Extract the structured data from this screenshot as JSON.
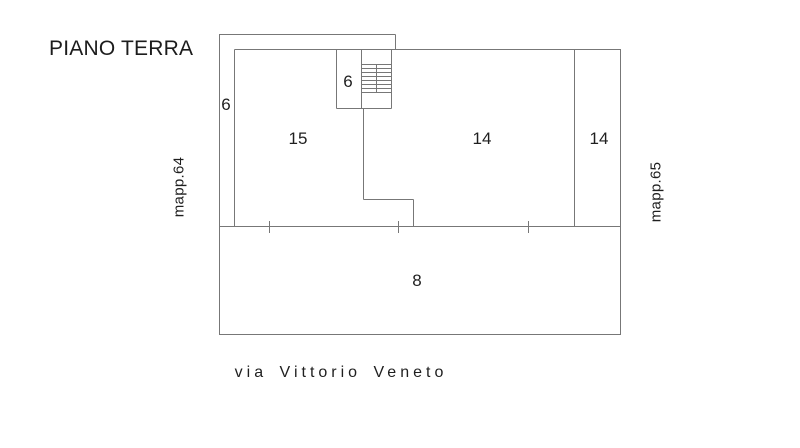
{
  "title": "PIANO TERRA",
  "plan": {
    "labels": {
      "corridor": "6",
      "stairwell": "6",
      "room_left": "15",
      "room_center": "14",
      "room_right": "14",
      "room_front": "8"
    },
    "parcel_left": "mapp.64",
    "parcel_right": "mapp.65",
    "street": "via Vittorio Veneto"
  },
  "colors": {
    "background": "#ffffff",
    "line": "#777777",
    "text": "#1f1f1f"
  }
}
